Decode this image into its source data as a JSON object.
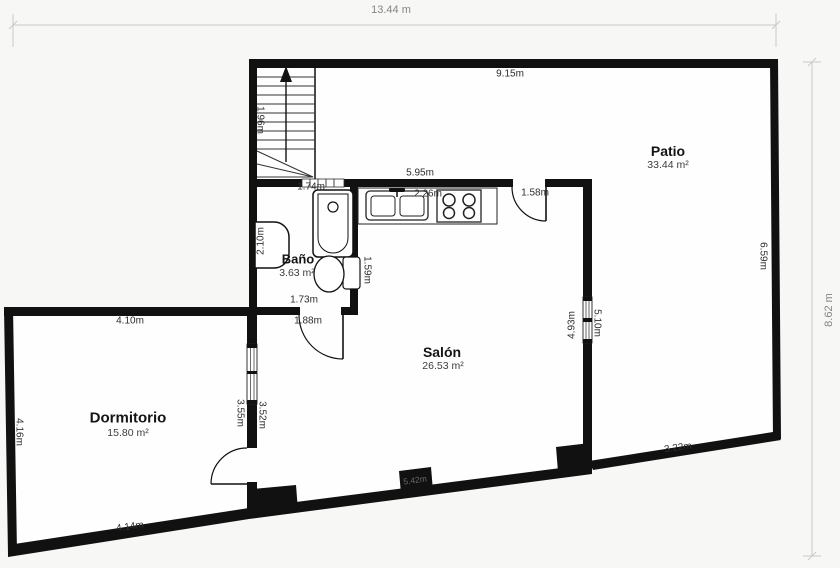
{
  "outer_dimensions": {
    "top": "13.44 m",
    "right": "8.62 m"
  },
  "rooms": {
    "patio": {
      "name": "Patio",
      "area": "33.44 m²"
    },
    "salon": {
      "name": "Salón",
      "area": "26.53 m²"
    },
    "bano": {
      "name": "Baño",
      "area": "3.63 m²"
    },
    "dormitorio": {
      "name": "Dormitorio",
      "area": "15.80 m²"
    }
  },
  "measurements": {
    "patio_top": "9.15m",
    "patio_right": "6.59m",
    "patio_bottom": "3.22m",
    "patio_left": "5.10m",
    "kitchen_wall": "5.95m",
    "kitchen_counter": "2.26m",
    "patio_door": "1.58m",
    "stairs": "1.96m",
    "bano_top": "1.74m",
    "bano_left": "2.10m",
    "bano_right": "1.59m",
    "bano_bottom": "1.73m",
    "salon_door_wall": "1.88m",
    "salon_right": "4.93m",
    "salon_left": "3.52m",
    "salon_bottom": "5.42m",
    "dorm_top": "4.10m",
    "dorm_left": "4.16m",
    "dorm_right": "3.55m",
    "dorm_bottom": "4.14m"
  },
  "icons": {
    "stairs": "stairs-up",
    "bathtub": "bathtub",
    "toilet": "toilet",
    "washbasin": "washbasin",
    "kitchen_sink": "double-sink",
    "stove": "4-burner-stove"
  },
  "colors": {
    "wall": "#111111",
    "room_fill": "#fefefe",
    "background": "#f7f7f5",
    "dimension_line": "#c9c9c9",
    "outer_dimension_text": "#858585",
    "measurement_text": "#2d2d2d"
  }
}
